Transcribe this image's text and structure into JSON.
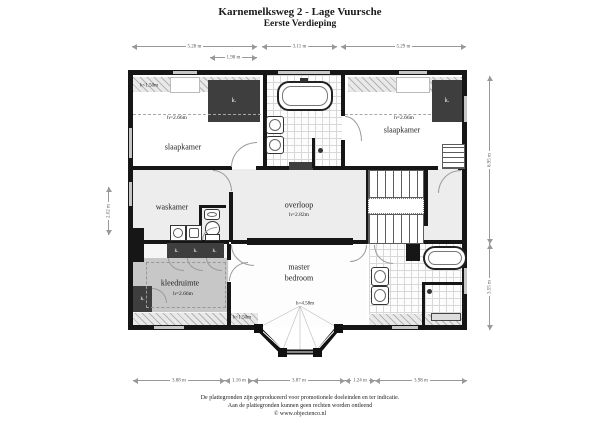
{
  "title": {
    "line1": "Karnemelksweg 2 - Lage Vuursche",
    "line2": "Eerste Verdieping"
  },
  "labels": {
    "closet": "k."
  },
  "rooms": {
    "slaapkamer_left": {
      "name": "slaapkamer",
      "height": "h=2.66m",
      "low_height": "h<1.50m"
    },
    "slaapkamer_right": {
      "name": "slaapkamer",
      "height": "h=2.66m"
    },
    "waskamer": {
      "name": "waskamer"
    },
    "overloop": {
      "name": "overloop",
      "height": "h=2.82m"
    },
    "kleedruimte": {
      "name": "kleedruimte",
      "height": "h=2.66m"
    },
    "master_bedroom": {
      "name_line1": "master",
      "name_line2": "bedroom",
      "height": "h=4.58m",
      "low_height": "h<1.50m"
    }
  },
  "dimensions": {
    "top": [
      "5.28 m",
      "3.11 m",
      "5.29 m"
    ],
    "top_sub": "1.98 m",
    "bottom": [
      "3.88 m",
      "1.16 m",
      "3.87 m",
      "1.24 m",
      "3.98 m"
    ],
    "left": "2.02 m",
    "right": [
      "6.95 m",
      "3.55 m"
    ]
  },
  "footer": {
    "line1": "De plattegronden zijn geproduceerd voor promotionele doeleinden en ter indicatie.",
    "line2": "Aan de plattegronden kunnen geen rechten worden ontleend",
    "line3": "© www.objectenco.nl"
  }
}
